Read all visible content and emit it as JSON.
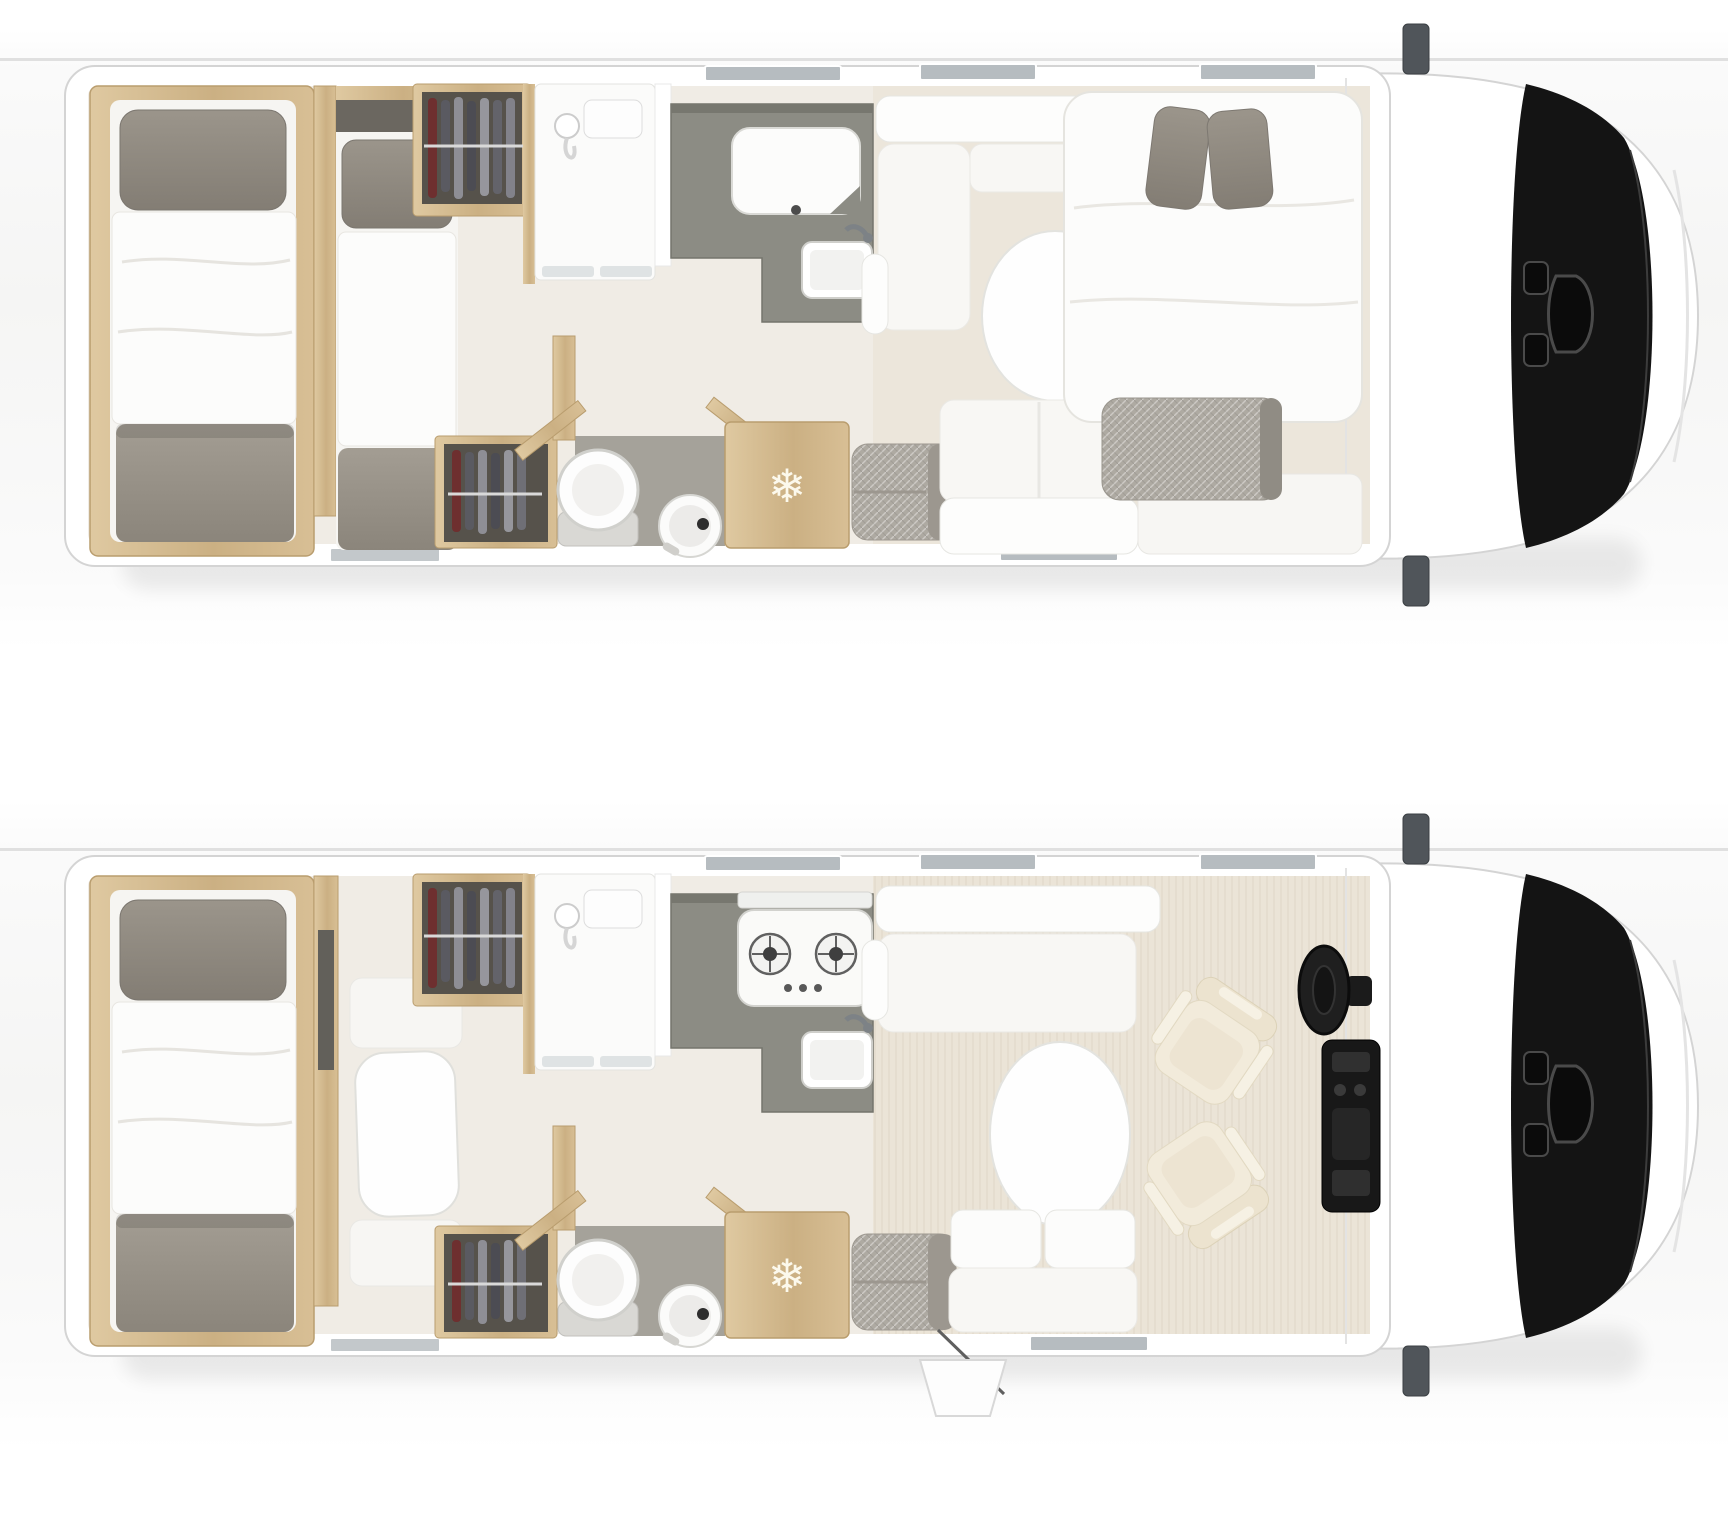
{
  "icons": {
    "snowflake": "❄"
  },
  "colors": {
    "body_white": "#ffffff",
    "outline_gray": "#d4d4d4",
    "windshield_black": "#141414",
    "mirror_gray": "#50555a",
    "wood_tan": "#d3bb90",
    "kitchen_counter_gray": "#8c8c84",
    "wc_floor_gray": "#a5a29a",
    "fabric_gray": "#948f87",
    "bedding_white": "#fcfcfb",
    "seat_cream": "#f2ebdb",
    "window_gray": "#b6bcc0",
    "floor_light": "#f0ece5",
    "lounge_floor_wood": "#ebe4d7"
  },
  "plans": [
    {
      "name": "upper-floorplan-night-layout",
      "elements": [
        "rear-twin-single-beds",
        "wardrobe-with-clothes",
        "shower-room",
        "kitchen-worktop-covered",
        "wc-toilet-and-basin",
        "fridge",
        "corner-bench",
        "oval-table",
        "lounge-sofa",
        "drop-down-double-bed",
        "cab-with-windshield",
        "side-mirrors"
      ]
    },
    {
      "name": "lower-floorplan-day-layout",
      "elements": [
        "rear-single-bed",
        "dinette-table-and-benches",
        "wardrobe-with-clothes",
        "shower-room",
        "kitchen-hob-and-sink",
        "wc-toilet-and-basin",
        "fridge",
        "corner-bench",
        "oval-table",
        "two-seat-sofa",
        "swivel-cab-seats",
        "steering-wheel",
        "dashboard",
        "entry-door-open",
        "entry-step",
        "side-mirrors"
      ]
    }
  ]
}
